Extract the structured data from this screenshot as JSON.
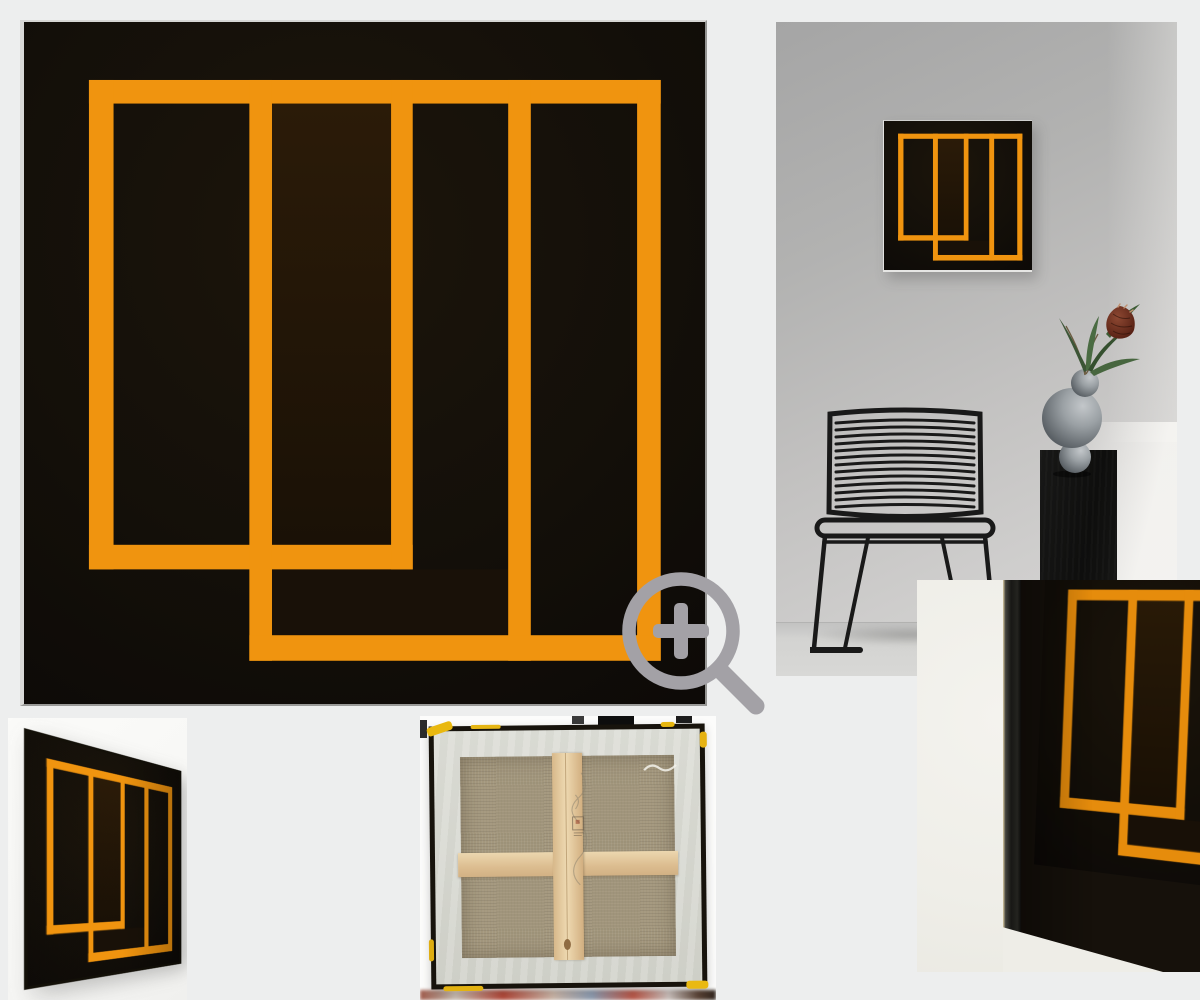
{
  "page": {
    "title": "Artwork photo gallery",
    "background_color": "#EDEEEE"
  },
  "artwork": {
    "style": "abstract geometric painting, orange interlocking frames and bars on black canvas",
    "colors": {
      "orange": "#F0940F",
      "canvas_black": "#14100A"
    }
  },
  "gallery": {
    "images": [
      {
        "id": "main",
        "label": "Front view of the painting"
      },
      {
        "id": "interior",
        "label": "Painting hanging on a grey wall above a black wire chair and a black plinth with a sphere vase and protea flower"
      },
      {
        "id": "closeup",
        "label": "Close-up angled detail of the canvas edge and painted surface"
      },
      {
        "id": "angled",
        "label": "Angled side view of the stretched canvas"
      },
      {
        "id": "back",
        "label": "Back of the canvas showing wooden stretcher frame and cross braces"
      }
    ]
  },
  "zoom_button": {
    "icon": "magnifier-plus-icon",
    "color": "#A3A1A6"
  },
  "scene_colors": {
    "wall_grey": "#BDBDBC",
    "floor_grey": "#D3D3D1",
    "closeup_wall": "#F0EFE9",
    "linen": "#A3977D",
    "pine_wood": "#E4C79C",
    "whitewash": "#D8D9D2",
    "paint_drip_yellow": "#E8B711"
  }
}
